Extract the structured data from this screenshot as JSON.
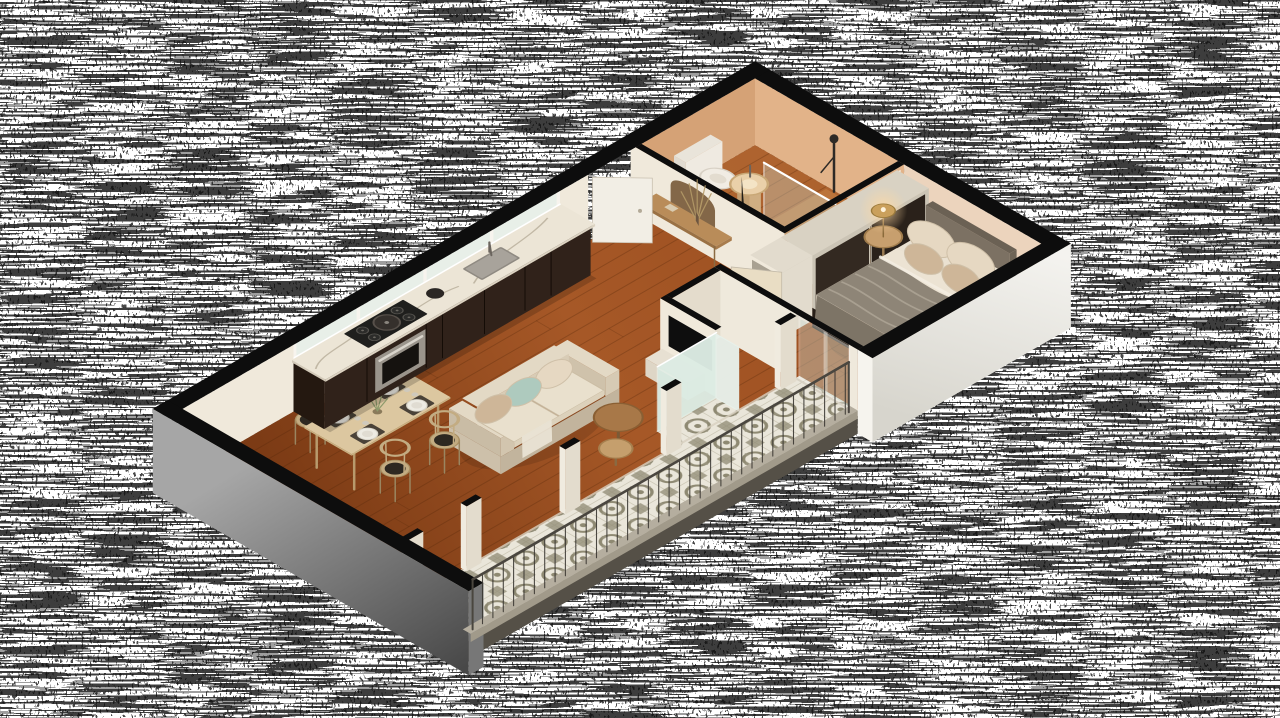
{
  "scene": {
    "kind": "isometric-3d-floor-plan-render",
    "background": "transparent-dither-noise",
    "apartment_type": "one-bedroom-with-balcony"
  },
  "palette": {
    "bg": "#ffffff",
    "noiseInk": "#0a0a0a",
    "capBlack": "#0d0d0d",
    "woodPlankLine": "#4e2408",
    "bathWoodTint": "#c07b40",
    "tileBase": "#eae6da",
    "tileMotif": "#8e8972",
    "wallCream": "#f0e9db",
    "wallCreamDim": "#e4dccc",
    "wallPeach": "#e2b389",
    "wallPeachDim": "#d5a276",
    "wallPeachLight": "#ecd4bd",
    "slabEdge": "#555047",
    "kitchenBase": "#30221a",
    "counterTop": "#ece5d6",
    "counterEdge": "#dcd3c2",
    "marbleVein": "#b7ac99",
    "steelDark": "#6b655e",
    "sofaBase": "#cdc0aa",
    "sofaSide": "#c2b49d",
    "sofaLight": "#e3d9c5",
    "cushion": "#e9e0cd",
    "pillowBlue": "#aecabe",
    "pillowTan": "#ceb698",
    "pillowCream": "#e6d8c2",
    "bedBase": "#281f18",
    "mattress": "#eae1d1",
    "mattressSide": "#dcd2c0",
    "headboard": "#7c7163",
    "headboardTop": "#6b6154",
    "blanket": "#8e8577",
    "blanketLight": "#a9a091",
    "blanketDark": "#7d7466",
    "wardrobeDark": "#2a211a",
    "wardrobeFrame": "#cbc4b5",
    "wardrobeTop": "#d9d2c3",
    "shelfUnit": "#e2dbcd",
    "shelfRecess": "#a9a192",
    "doorWhite": "#f2eee5",
    "doorLight": "#e9ddc4",
    "doorDark": "#221d17",
    "doorEdge": "#c2b9a8",
    "glass": "#cfe2da",
    "frosted": "#dcebe3",
    "frostedLight": "#e7f1ea",
    "frameWhite": "#f7f4ee",
    "railMetal": "#3a3732",
    "railTop": "#4a463f",
    "curbTop": "#b5ae9f",
    "curbFace": "#a19a8a",
    "lampBrass": "#caa05c",
    "lampGlow": "#ffd9a3",
    "tableWood": "#dcc7a0",
    "tableEdge": "#c9b183",
    "chairWood": "#c3ac82",
    "chairSeat": "#1d1a16",
    "placemat": "#4a4238",
    "plate": "#edebe3",
    "plateRim": "#d8d4c9",
    "archNiche": "#836748",
    "shelfWood": "#b98c59",
    "sprig": "#b49a68",
    "tv": "#0e0e0e"
  },
  "floors": {
    "interior": "wood-planks",
    "bathroom": "warm-wood",
    "balcony": "encaustic-patterned-cement-tiles"
  },
  "rooms": [
    {
      "name": "bathroom",
      "furniture": [
        "walk-in-shower",
        "shower-glass-screen",
        "shower-column",
        "toilet",
        "pedestal-sink",
        "dark-swing-door"
      ]
    },
    {
      "name": "entry-hall",
      "furniture": [
        "entrance-door",
        "arched-wall-niche",
        "wood-console-shelf",
        "dried-flowers",
        "soap-dish"
      ]
    },
    {
      "name": "bedroom",
      "furniture": [
        "double-bed",
        "upholstered-headboard",
        "pillows",
        "throw-blanket",
        "round-bedside-table",
        "brass-table-lamp",
        "sliding-door-wardrobe",
        "open-shelf-unit",
        "swing-door",
        "sliding-glass-door"
      ]
    },
    {
      "name": "living-dining",
      "furniture": [
        "three-seat-sofa",
        "throw-pillows",
        "round-coffee-tables",
        "tv-partition-wall",
        "tv",
        "media-bench",
        "dining-table",
        "wishbone-chairs",
        "place-settings",
        "flower-vase",
        "frosted-utility-niche"
      ]
    },
    {
      "name": "kitchen",
      "furniture": [
        "dark-cabinet-run",
        "marble-countertop",
        "undermount-sink",
        "faucet",
        "cooktop",
        "cooking-pot",
        "kettle",
        "built-in-oven",
        "window-band"
      ]
    },
    {
      "name": "balcony",
      "furniture": [
        "patterned-tile-floor",
        "concrete-curb",
        "metal-railing",
        "white-door-piers",
        "glass-pane"
      ]
    }
  ]
}
